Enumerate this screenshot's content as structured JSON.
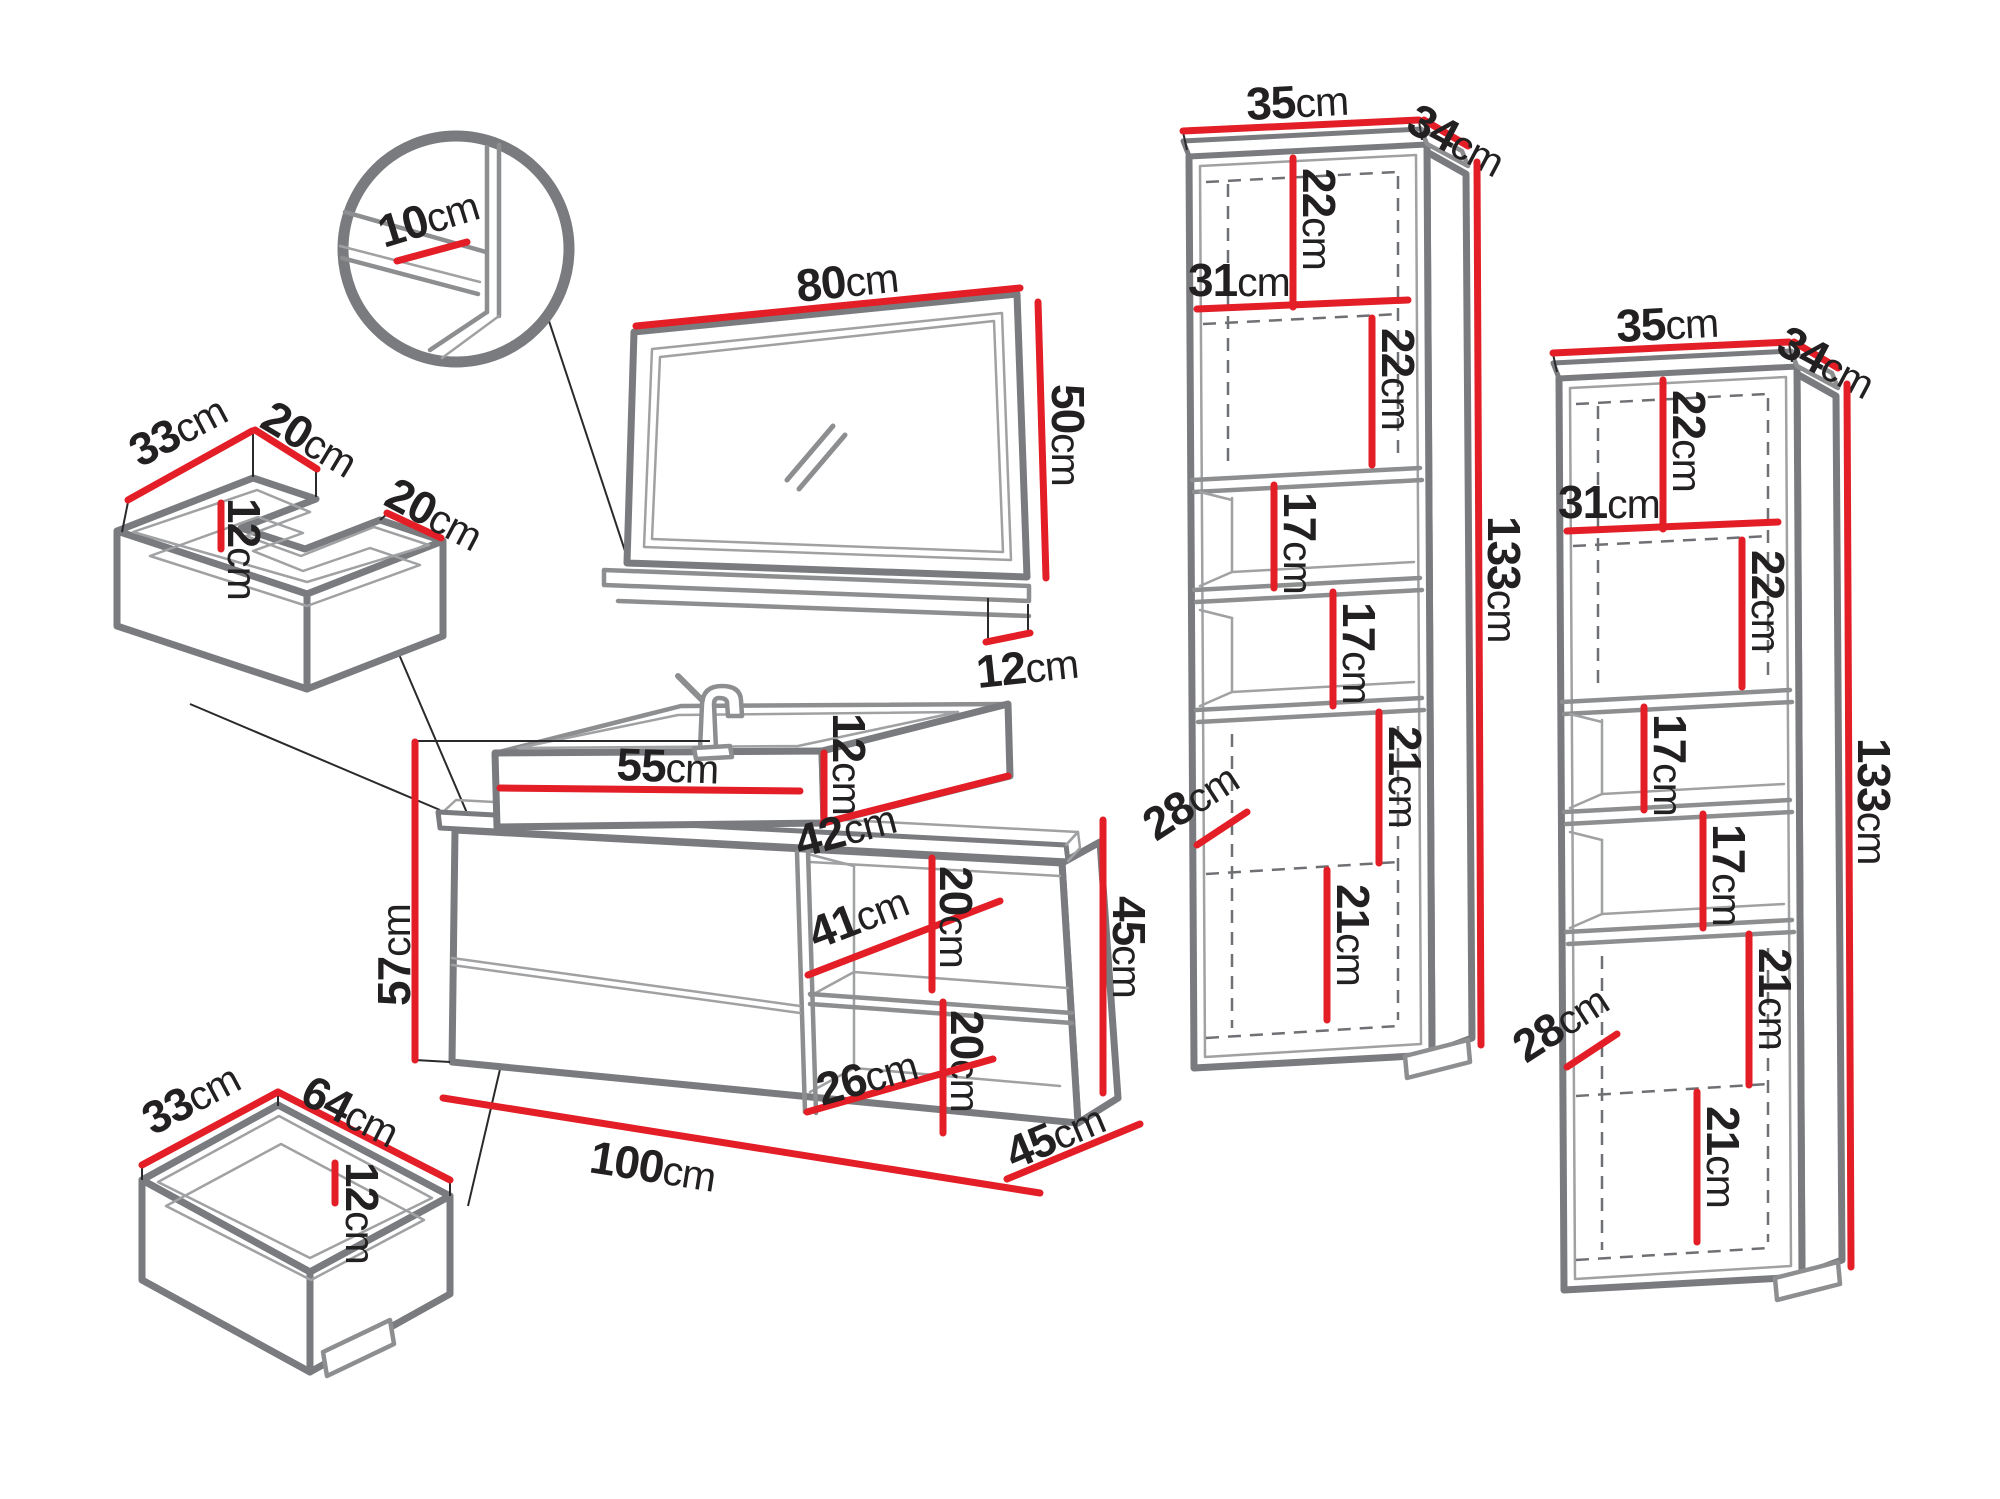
{
  "colors": {
    "accent_red": "#e31e26",
    "line_gray": "#7a7b7e",
    "text_dark": "#232021",
    "background": "#ffffff"
  },
  "pieces": {
    "detail_circle": {
      "shelf_depth": {
        "v": "10",
        "u": "cm"
      }
    },
    "mirror": {
      "width": {
        "v": "80",
        "u": "cm"
      },
      "height": {
        "v": "50",
        "u": "cm"
      },
      "shelf_depth": {
        "v": "12",
        "u": "cm"
      }
    },
    "top_drawer": {
      "depth": {
        "v": "33",
        "u": "cm"
      },
      "arm_left": {
        "v": "20",
        "u": "cm"
      },
      "arm_right": {
        "v": "20",
        "u": "cm"
      },
      "height": {
        "v": "12",
        "u": "cm"
      }
    },
    "bottom_drawer": {
      "depth": {
        "v": "33",
        "u": "cm"
      },
      "width": {
        "v": "64",
        "u": "cm"
      },
      "height": {
        "v": "12",
        "u": "cm"
      }
    },
    "vanity": {
      "total_height": {
        "v": "57",
        "u": "cm"
      },
      "basin_width": {
        "v": "55",
        "u": "cm"
      },
      "basin_height": {
        "v": "12",
        "u": "cm"
      },
      "basin_depth": {
        "v": "42",
        "u": "cm"
      },
      "niche_top_width": {
        "v": "41",
        "u": "cm"
      },
      "niche_top_height": {
        "v": "20",
        "u": "cm"
      },
      "niche_bottom_height": {
        "v": "20",
        "u": "cm"
      },
      "niche_bottom_width": {
        "v": "26",
        "u": "cm"
      },
      "cabinet_width": {
        "v": "100",
        "u": "cm"
      },
      "cabinet_height": {
        "v": "45",
        "u": "cm"
      },
      "cabinet_depth": {
        "v": "45",
        "u": "cm"
      }
    },
    "cabinet1": {
      "width": {
        "v": "35",
        "u": "cm"
      },
      "depth": {
        "v": "34",
        "u": "cm"
      },
      "top_section_a": {
        "v": "22",
        "u": "cm"
      },
      "inner_width": {
        "v": "31",
        "u": "cm"
      },
      "top_section_b": {
        "v": "22",
        "u": "cm"
      },
      "shelf_a": {
        "v": "17",
        "u": "cm"
      },
      "shelf_b": {
        "v": "17",
        "u": "cm"
      },
      "bottom_section_a": {
        "v": "21",
        "u": "cm"
      },
      "inner_depth": {
        "v": "28",
        "u": "cm"
      },
      "bottom_section_b": {
        "v": "21",
        "u": "cm"
      },
      "total_height": {
        "v": "133",
        "u": "cm"
      }
    },
    "cabinet2": {
      "width": {
        "v": "35",
        "u": "cm"
      },
      "depth": {
        "v": "34",
        "u": "cm"
      },
      "top_section_a": {
        "v": "22",
        "u": "cm"
      },
      "inner_width": {
        "v": "31",
        "u": "cm"
      },
      "top_section_b": {
        "v": "22",
        "u": "cm"
      },
      "shelf_a": {
        "v": "17",
        "u": "cm"
      },
      "shelf_b": {
        "v": "17",
        "u": "cm"
      },
      "bottom_section_a": {
        "v": "21",
        "u": "cm"
      },
      "inner_depth": {
        "v": "28",
        "u": "cm"
      },
      "bottom_section_b": {
        "v": "21",
        "u": "cm"
      },
      "total_height": {
        "v": "133",
        "u": "cm"
      }
    }
  }
}
